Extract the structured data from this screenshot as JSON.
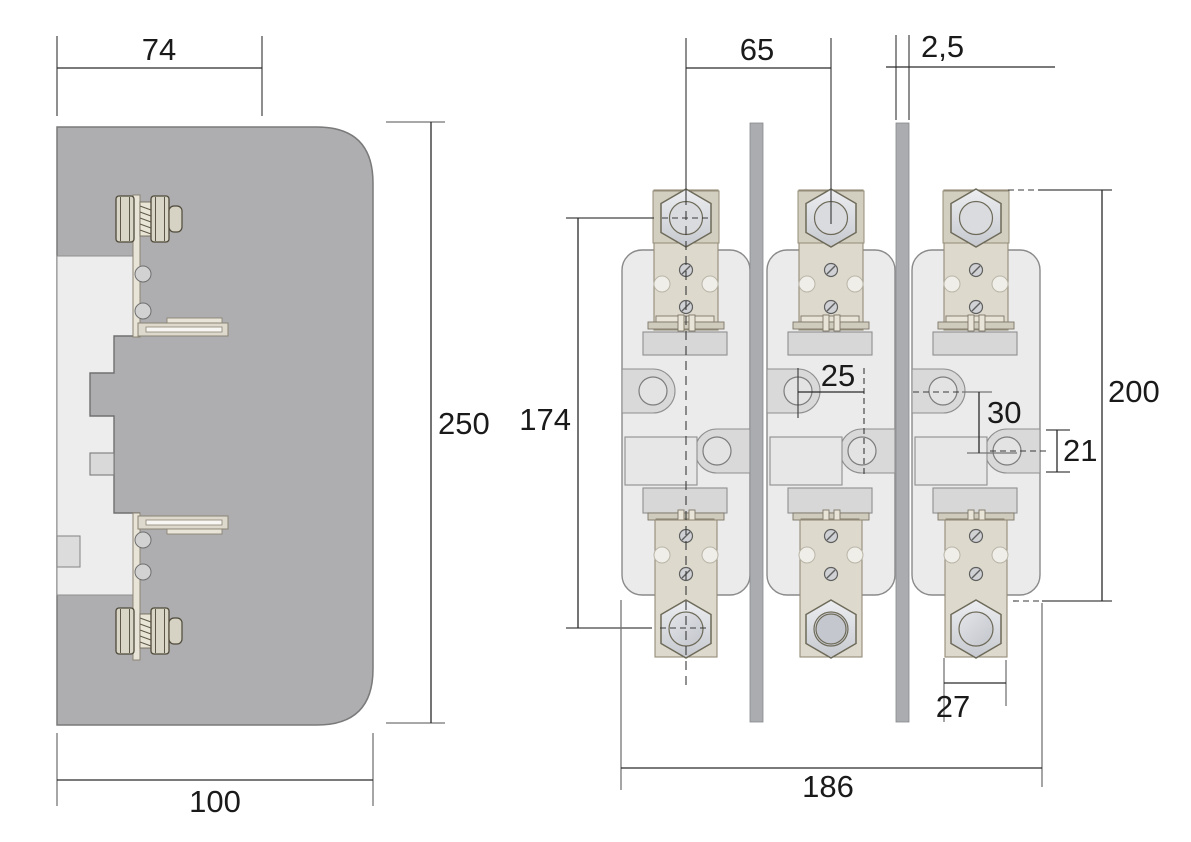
{
  "drawing": {
    "colors": {
      "body_gray": "#aeaeb0",
      "panel_light": "#ededed",
      "module_fill": "#ebebeb",
      "terminal_beige": "#ddd9cd",
      "pad_beige": "#d2cec0",
      "metal_light": "#dcdee2",
      "inner_gray": "#d7d7d7",
      "separator_gray": "#aaacaf",
      "dimension_line": "#2a2a2a",
      "extension_line": "#757575"
    },
    "views": {
      "side": {
        "dims": {
          "top_width": "74",
          "height": "250",
          "bottom_width": "100"
        }
      },
      "front": {
        "dims": {
          "pole_spacing": "65",
          "separator_thickness": "2,5",
          "terminal_span": "174",
          "hole_offset_horizontal": "25",
          "hole_offset_vertical": "30",
          "terminal_tab_height": "21",
          "overall_height": "200",
          "terminal_width": "27",
          "overall_width": "186"
        }
      }
    }
  }
}
